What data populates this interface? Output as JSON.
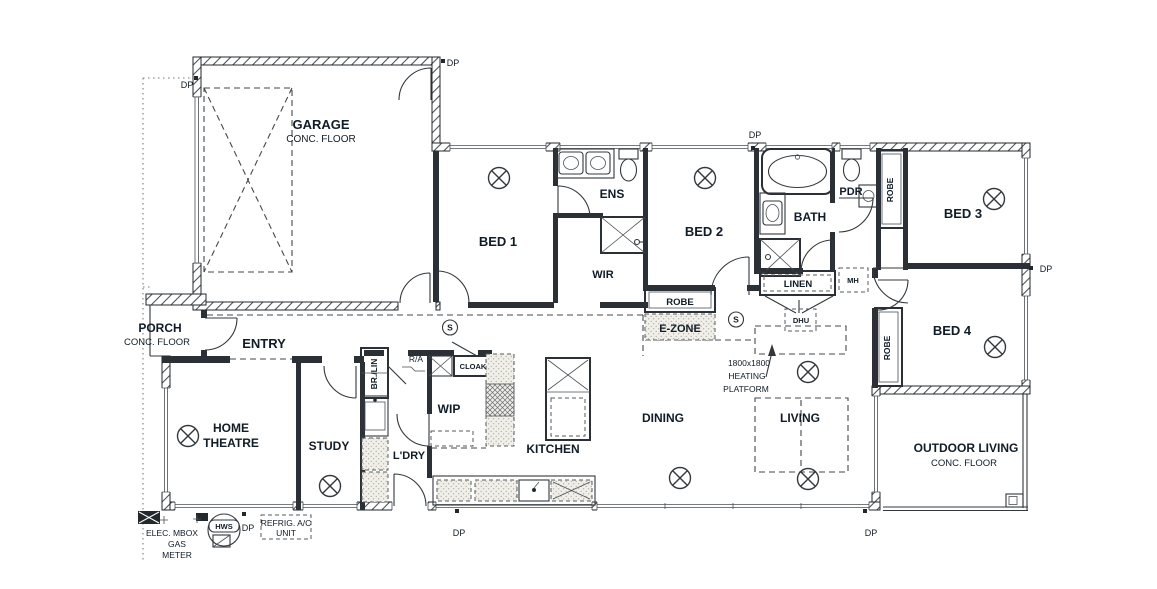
{
  "document": {
    "type": "floor-plan"
  },
  "rooms": {
    "garage": {
      "name": "GARAGE",
      "floor": "CONC. FLOOR"
    },
    "porch": {
      "name": "PORCH",
      "floor": "CONC. FLOOR"
    },
    "entry": {
      "name": "ENTRY"
    },
    "home_theatre": {
      "name_line1": "HOME",
      "name_line2": "THEATRE"
    },
    "study": {
      "name": "STUDY"
    },
    "laundry": {
      "name": "L'DRY"
    },
    "wip": {
      "name": "WIP"
    },
    "kitchen": {
      "name": "KITCHEN"
    },
    "dining": {
      "name": "DINING"
    },
    "living": {
      "name": "LIVING"
    },
    "bed1": {
      "name": "BED 1"
    },
    "bed2": {
      "name": "BED 2"
    },
    "bed3": {
      "name": "BED 3"
    },
    "bed4": {
      "name": "BED 4"
    },
    "ensuite": {
      "name": "ENS"
    },
    "wir": {
      "name": "WIR"
    },
    "bath": {
      "name": "BATH"
    },
    "powder": {
      "name": "PDR"
    },
    "ezone": {
      "name": "E-ZONE"
    },
    "outdoor_living": {
      "name": "OUTDOOR LIVING",
      "floor": "CONC. FLOOR"
    }
  },
  "storage": {
    "robe": "ROBE",
    "linen": "LINEN",
    "cloak": "CLOAK",
    "broom_linen": "BR./LIN"
  },
  "annotations": {
    "downpipe": "DP",
    "return_air": "R/A",
    "manhole": "MH",
    "ducted_heating_unit": "DHU",
    "hot_water_service": "HWS",
    "smoke_alarm": "S",
    "heating_platform": {
      "line1": "1800x1800",
      "line2": "HEATING",
      "line3": "PLATFORM"
    },
    "meters": {
      "line1": "ELEC. MBOX",
      "line2": "GAS",
      "line3": "METER"
    },
    "ac_unit": {
      "line1": "REFRIG. A/C",
      "line2": "UNIT"
    }
  },
  "colors": {
    "wall": "#23282c",
    "text": "#101c28",
    "background": "#ffffff",
    "casework_fill": "#efede7"
  }
}
